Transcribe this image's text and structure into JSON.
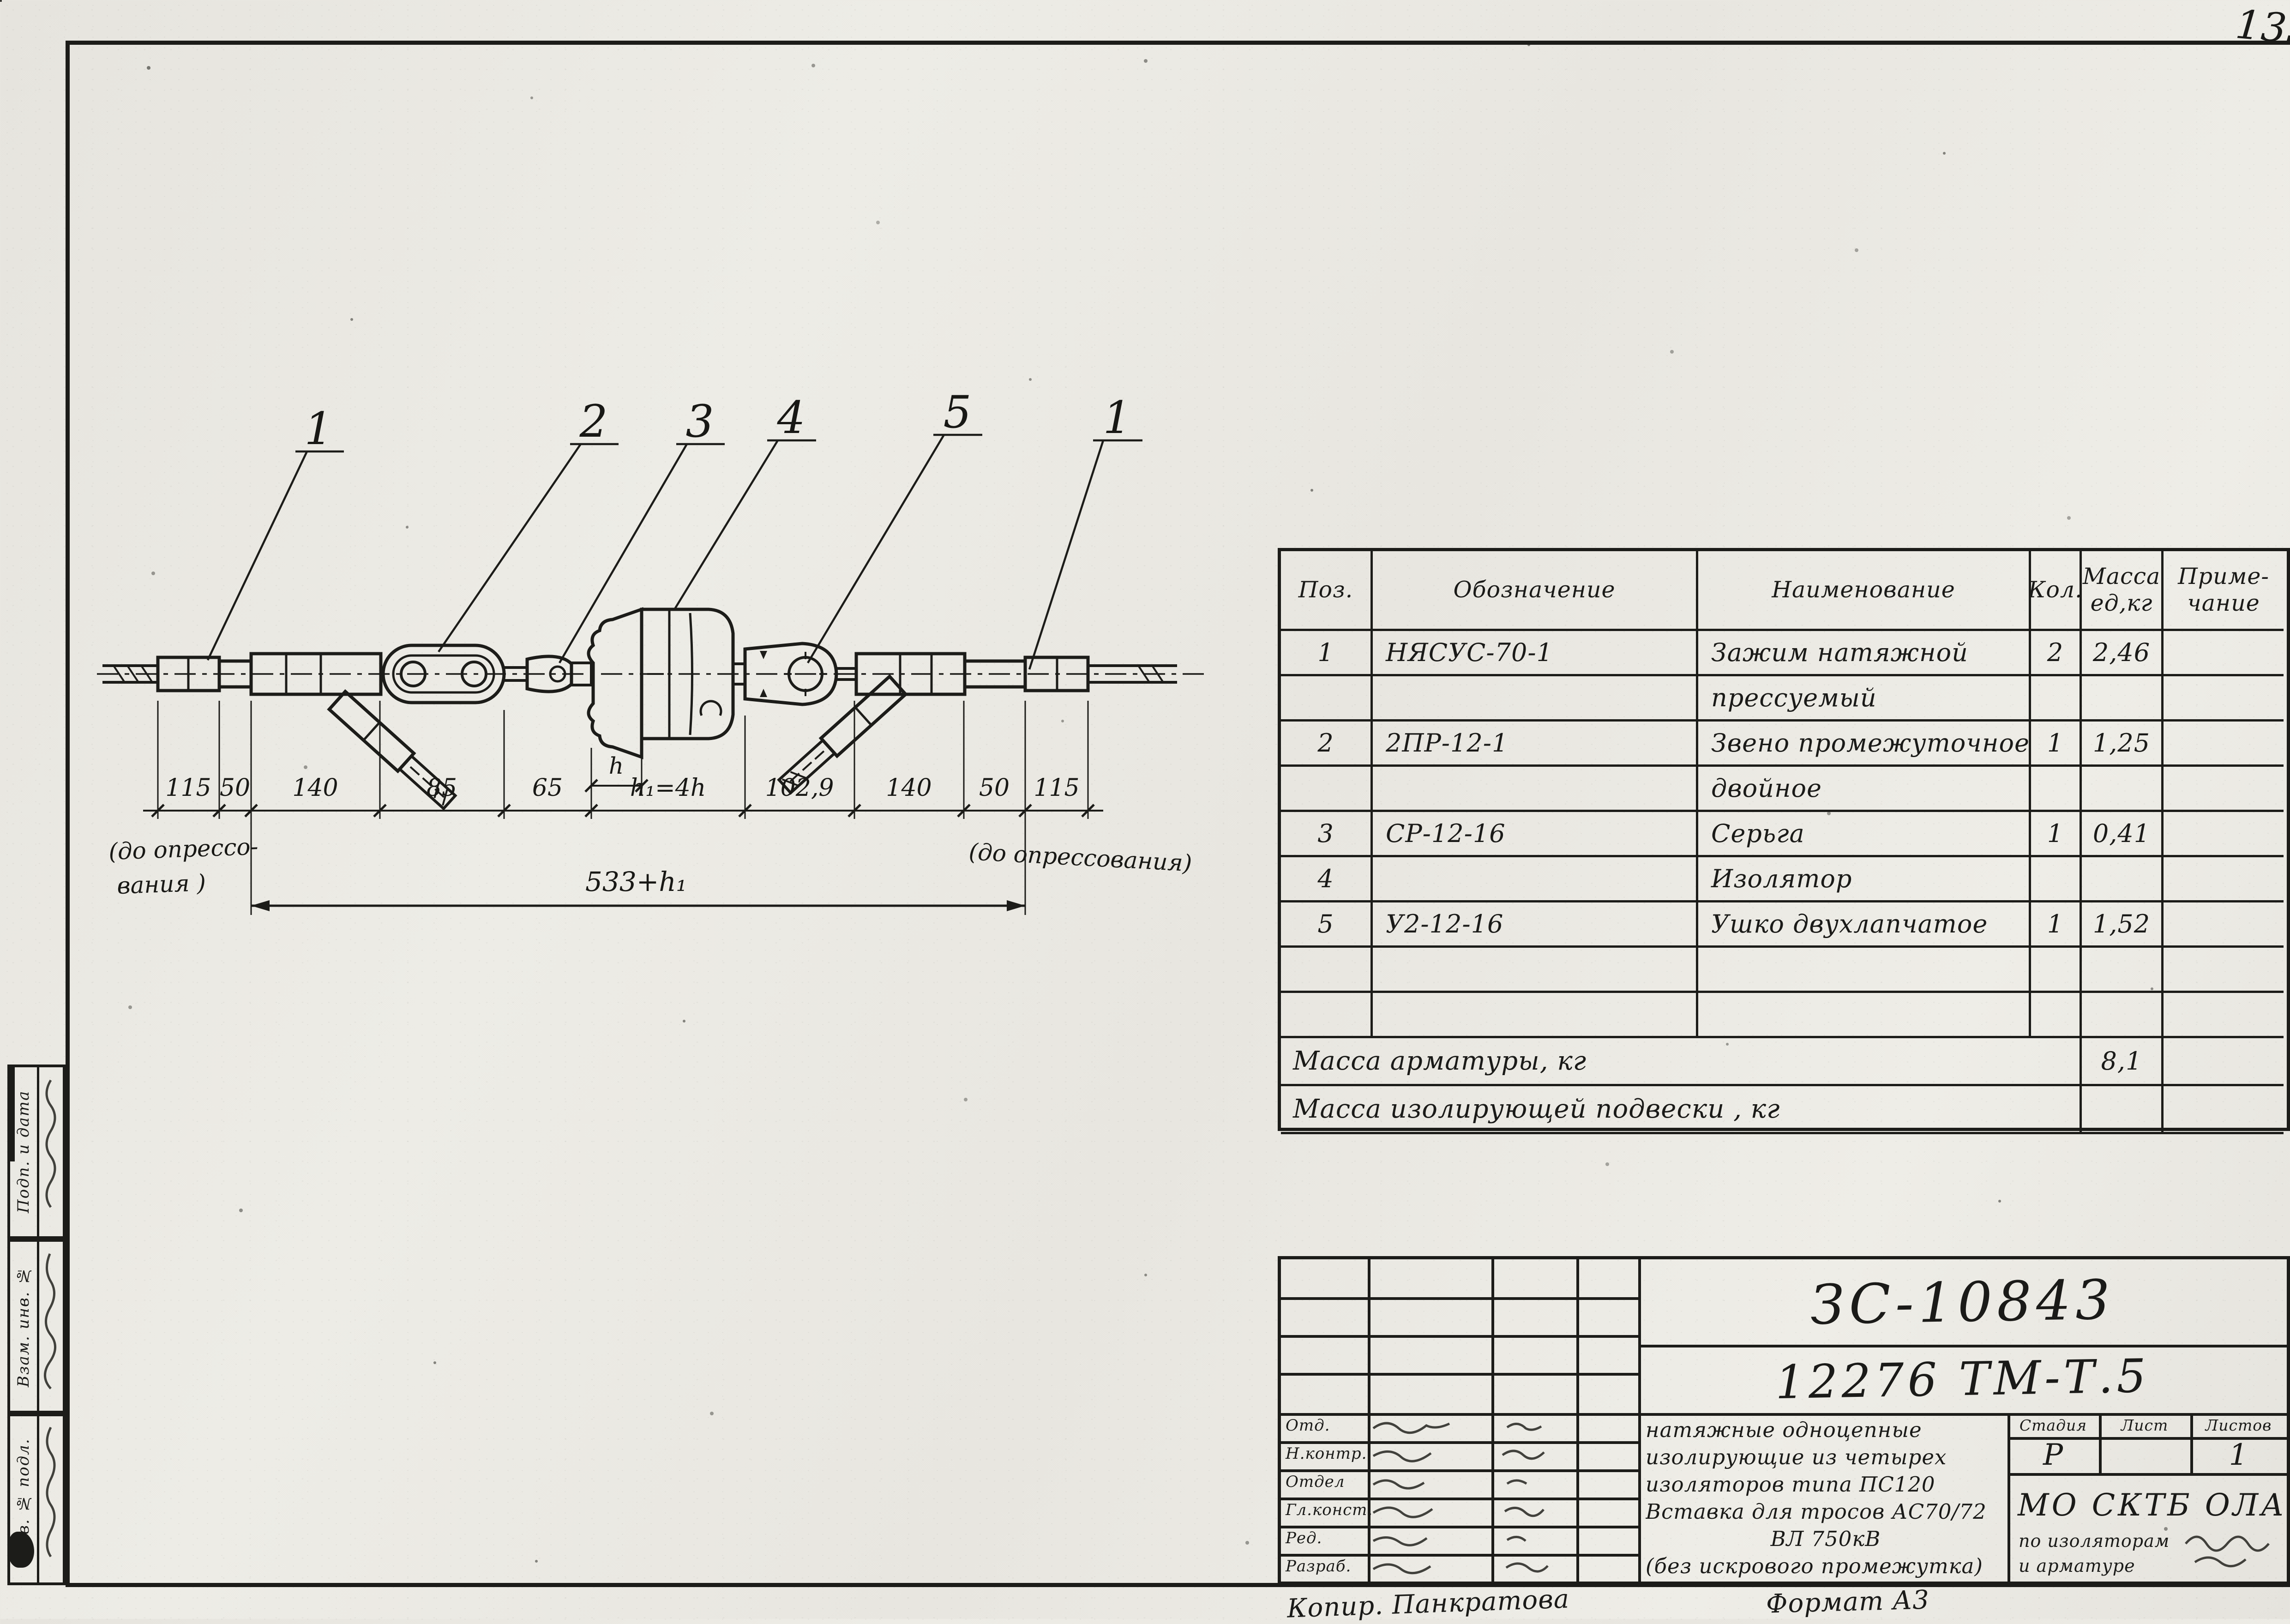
{
  "colors": {
    "ink": "#1c1c19",
    "paper": "#e9e7e1"
  },
  "page": {
    "corner_note": "135",
    "copier_note": "Копир. Панкратова",
    "format_note": "Формат А3"
  },
  "drawing": {
    "callouts": [
      "1",
      "2",
      "3",
      "4",
      "5",
      "1"
    ],
    "dim_chain": [
      "115",
      "50",
      "140",
      "85",
      "65",
      "h₁=4h",
      "102,9",
      "140",
      "50",
      "115"
    ],
    "dim_h": "h",
    "dim_total": "533+h₁",
    "note_left_1": "(до опрессо-",
    "note_left_2": "вания )",
    "note_right": "(до опрессования)"
  },
  "parts_table": {
    "headers": {
      "pos": "Поз.",
      "designation": "Обозначение",
      "name": "Наименование",
      "qty": "Кол.",
      "mass_1": "Масса",
      "mass_2": "ед,кг",
      "note_1": "Приме-",
      "note_2": "чание"
    },
    "rows": [
      {
        "pos": "1",
        "designation": "НЯСУС-70-1",
        "name": "Зажим натяжной",
        "qty": "2",
        "mass": "2,46",
        "note": ""
      },
      {
        "pos": "",
        "designation": "",
        "name": "прессуемый",
        "qty": "",
        "mass": "",
        "note": ""
      },
      {
        "pos": "2",
        "designation": "2ПР-12-1",
        "name": "Звено промежуточное",
        "qty": "1",
        "mass": "1,25",
        "note": ""
      },
      {
        "pos": "",
        "designation": "",
        "name": "двойное",
        "qty": "",
        "mass": "",
        "note": ""
      },
      {
        "pos": "3",
        "designation": "СР-12-16",
        "name": "Серьга",
        "qty": "1",
        "mass": "0,41",
        "note": ""
      },
      {
        "pos": "4",
        "designation": "",
        "name": "Изолятор",
        "qty": "",
        "mass": "",
        "note": ""
      },
      {
        "pos": "5",
        "designation": "У2-12-16",
        "name": "Ушко двухлапчатое",
        "qty": "1",
        "mass": "1,52",
        "note": ""
      },
      {
        "pos": "",
        "designation": "",
        "name": "",
        "qty": "",
        "mass": "",
        "note": ""
      },
      {
        "pos": "",
        "designation": "",
        "name": "",
        "qty": "",
        "mass": "",
        "note": ""
      }
    ],
    "summary": [
      {
        "label": "Масса арматуры, кг",
        "value": "8,1"
      },
      {
        "label": "Масса изолирующей подвески , кг",
        "value": ""
      }
    ]
  },
  "title_block": {
    "doc_number": "ЗС-10843",
    "doc_code": "12276 ТМ-Т.5",
    "description": [
      "натяжные одноцепные",
      "изолирующие из четырех",
      "изоляторов типа ПС120",
      "Вставка для тросов АС70/72",
      "ВЛ 750кВ",
      "(без искрового промежутка)"
    ],
    "stage_headers": [
      "Стадия",
      "Лист",
      "Листов"
    ],
    "stage_value": "Р",
    "sheet_value": "",
    "sheets_value": "1",
    "org_line_1": "МО СКТБ ОЛА",
    "org_line_2": "по изоляторам",
    "org_line_3": "и арматуре",
    "sign_roles": [
      "Отд.",
      "Н.контр.",
      "Отдел",
      "Гл.конст.",
      "Ред.",
      "Разраб."
    ]
  },
  "margin": {
    "labels": [
      "Подп. и дата",
      "Взам. инв. №",
      "Инв. № подл."
    ]
  }
}
